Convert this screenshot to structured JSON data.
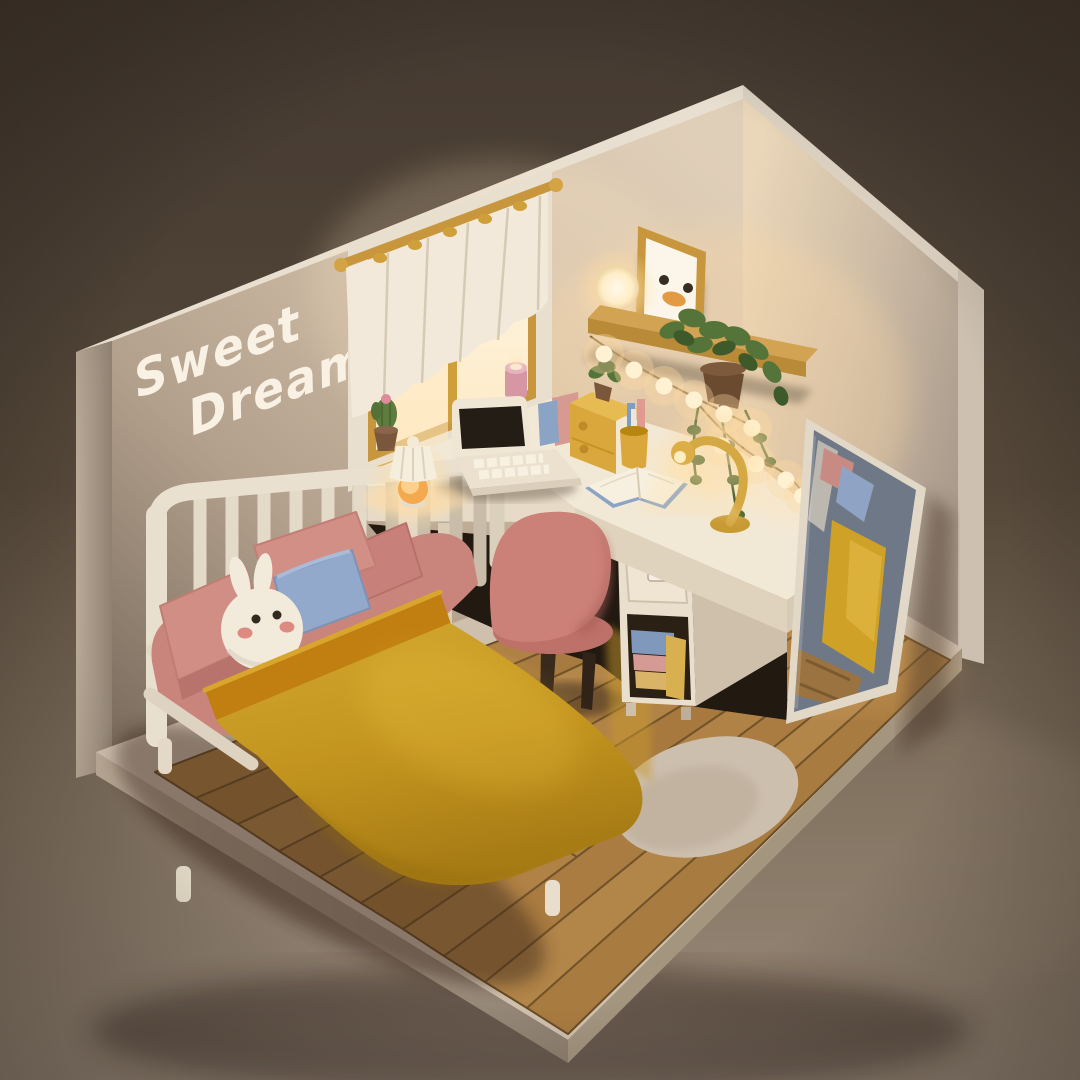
{
  "scene": {
    "title": "Sweet Dream",
    "type": "3d-isometric-room-render",
    "wall_text": {
      "line1": "Sweet",
      "line2": "Dream"
    },
    "objects": [
      "left-wall",
      "right-wall",
      "window",
      "curtain",
      "curtain-rod",
      "cactus-pot",
      "pink-candle",
      "wall-shelf",
      "globe-lamp",
      "duck-picture-frame",
      "hanging-plant",
      "string-lights",
      "corner-desk",
      "laptop",
      "bedside-lamp",
      "gooseneck-desk-lamp",
      "open-book",
      "pencil-cup",
      "mini-drawer-organizer",
      "standing-books",
      "drawer-cabinet",
      "cabinet-books",
      "pink-desk-chair",
      "bed",
      "headboard",
      "pink-pillows",
      "blue-pillow",
      "bunny-plush",
      "yellow-blanket",
      "standing-mirror",
      "wood-plank-floor",
      "round-rug"
    ],
    "palette": {
      "background_top": "#463b32",
      "background_bottom": "#98897a",
      "wall_light": "#d8c7b2",
      "wall_shadow": "#7b6d5f",
      "accent_gold": "#c8973d",
      "blanket_yellow": "#c89d24",
      "pillow_pink": "#d18e85",
      "pillow_blue": "#93a9cb",
      "chair_pink": "#cb8078",
      "wood_floor": "#a6793e",
      "desk_white": "#f2e8d6",
      "plant_green": "#55743a",
      "glow_warm": "#ffe9bf",
      "mirror_glass": "#6f7886"
    }
  }
}
